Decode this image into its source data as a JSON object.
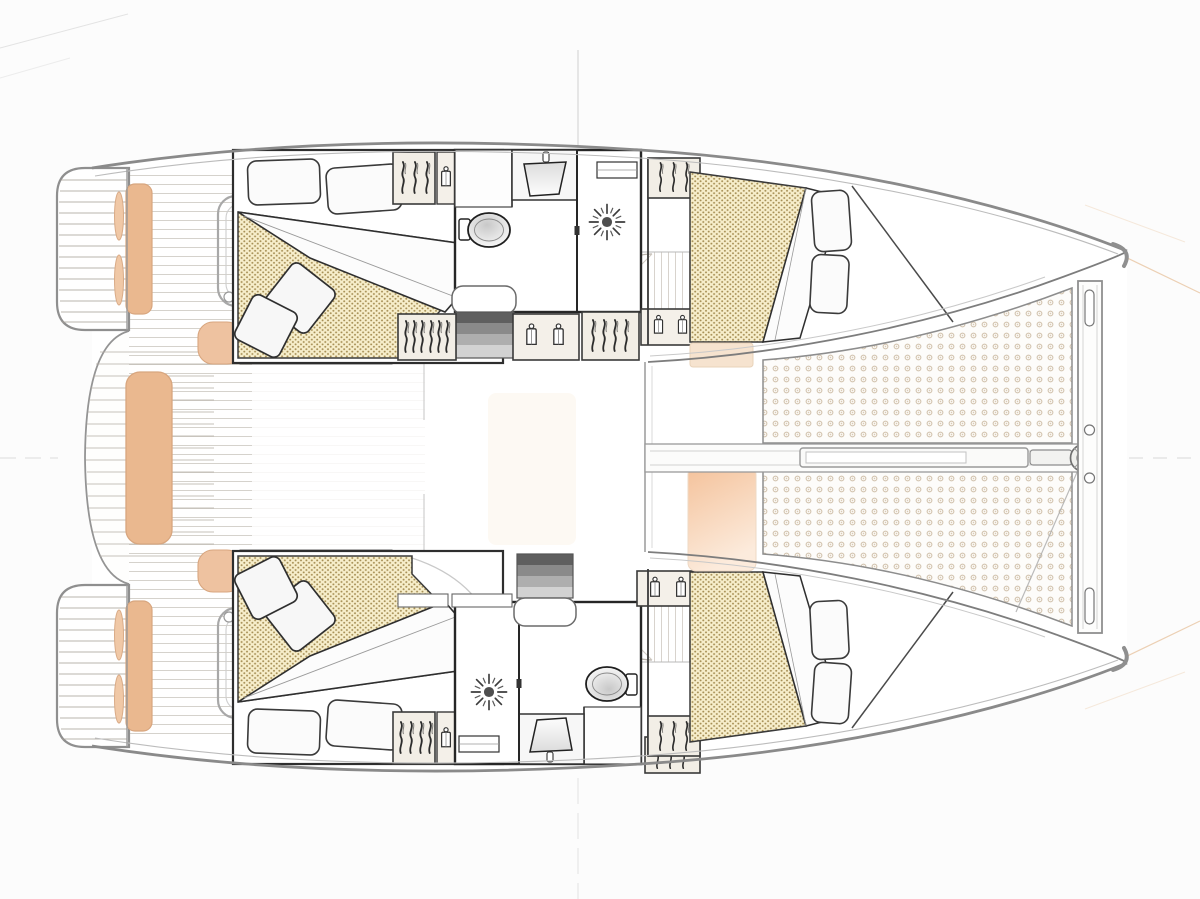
{
  "title": "Catamaran interior deck plan - top view, bow to the right",
  "colors": {
    "background": "#fcfcfc",
    "hull_outline": "#8a8a8a",
    "cabin_wall": "#2e2e2e",
    "cushion_tan": "#eab88f",
    "mattress_fill": "#f7eecb",
    "mattress_dot": "#a68f55",
    "trampoline_ring": "#cfbfa9",
    "foredeck_peach": "#f4c29b",
    "stair_dark": "#5f5f5f",
    "teak_line": "#b3aca2"
  },
  "aft_deck": {
    "label": "Aft deck and cockpit",
    "platform_port": "Port swim platform with teak steps and tan cushions (top)",
    "platform_starboard": "Starboard swim platform with teak steps and tan cushions (bottom)",
    "transom_bench": "Central transom bench with tan cushion",
    "cockpit_sole": "Teak cockpit sole",
    "seating_group_port": "Cockpit table and seating outline (top)",
    "seating_group_starboard": "Cockpit table and seating outline (bottom)",
    "settee_port": "Cockpit settee with dotted cushion (top)",
    "settee_starboard": "Cockpit settee with dotted cushion (bottom)",
    "settee_end_port": "Curved tan settee end (top)",
    "settee_end_starboard": "Curved tan settee end (bottom)"
  },
  "saloon": {
    "label": "Open-plan saloon and galley",
    "galley": "Galley block (faint outline)",
    "door_port": "Saloon door edge (top)",
    "door_starboard": "Saloon door edge (bottom)"
  },
  "hulls": {
    "port": {
      "label": "Port hull (top)",
      "aft_cabin": {
        "label": "Aft double cabin with island berth",
        "pillows": 2,
        "throw_pillows": 2
      },
      "wardrobe_aft": "Hanging wardrobe, 3 hangers",
      "jacket_locker_aft": "Locker with 1 hanging jacket",
      "bathroom": {
        "label": "Head: toilet, washbasin and separate shower"
      },
      "companionway": {
        "label": "Companionway steps down into hull",
        "steps": 4
      },
      "corridor": "Hull corridor, plank sole, two door swings",
      "wardrobe_mid": "Hanging wardrobe, 6 hangers",
      "jacket_locker_mid": "Locker with 2 hanging jackets",
      "wardrobe_fwd": "Hanging wardrobe, 4 hangers",
      "jacket_locker_fwd": "Locker with 2 hanging jackets",
      "forward_cabin": {
        "label": "Forward double cabin with angled berth",
        "pillows": 2
      },
      "wardrobe_forward_cabin": "Hanging wardrobe, 3 hangers",
      "bow_locker": "Forepeak storage wedge"
    },
    "starboard": {
      "label": "Starboard hull (bottom)",
      "aft_cabin": {
        "label": "Aft double cabin with island berth",
        "pillows": 2,
        "throw_pillows": 2
      },
      "wardrobe_aft": "Hanging wardrobe, 4 hangers",
      "jacket_locker_aft": "Locker with 1 hanging jacket",
      "bathroom": {
        "label": "Head: shower, washbasin and toilet (mirrored layout)"
      },
      "companionway": {
        "label": "Companionway steps down into hull",
        "steps": 4
      },
      "corridor": "Hull corridor, plank sole, two door swings",
      "cabinets_mid": "Worktop cabinets along corridor",
      "jacket_locker_mid": "Locker with 2 hanging jackets",
      "wardrobe_fwd": "Hanging wardrobe, 3 hangers",
      "forward_cabin": {
        "label": "Forward double cabin with angled berth",
        "pillows": 2
      },
      "wardrobe_forward_cabin": "Hanging wardrobe, 3 hangers",
      "bow_locker": "Forepeak storage wedge"
    }
  },
  "foredeck": {
    "walkway": "Central walkway between trampolines",
    "trampoline_port": "Trampoline net (top)",
    "trampoline_starboard": "Trampoline net (bottom)",
    "bowsprit": "Bowsprit beam with anchor roller",
    "crossbeam": "Forward crossbeam with fittings",
    "seat": "Forward seat with peach cushion",
    "deck_band": "Tan side-deck band",
    "bridle": "Trampoline bridle line"
  },
  "icons": {
    "shower": "shower-drain-icon",
    "toilet": "toilet-icon",
    "sink": "washbasin-icon",
    "hanger": "clothes-hanger-icon",
    "jacket": "hanging-jacket-icon",
    "anchor_roller": "anchor-roller-icon",
    "stairs": "companionway-steps-icon"
  }
}
